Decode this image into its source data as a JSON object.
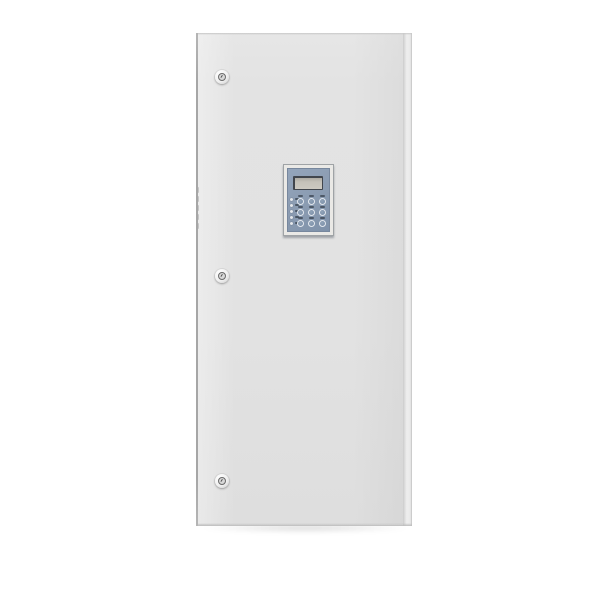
{
  "colors": {
    "background": "#ffffff",
    "cabinet_face": "#e2e2e2",
    "cabinet_side": "#eeeeee",
    "cabinet_edge_left": "#a6a6a6",
    "cabinet_edge_top": "#c9c9c9",
    "cabinet_edge_bottom": "#bdbdbd",
    "panel_bezel": "#eae9e6",
    "panel_face": "#8a9bb1",
    "panel_face_light": "#94a5bb",
    "panel_border": "#77879d",
    "lcd_frame": "#41464d",
    "lcd_screen": "#c4c1b9",
    "button_face": "#7e92aa",
    "button_ring": "#e3e8ee",
    "button_label": "#39434f",
    "led_dot": "#e4e8ec",
    "latch_face": "#f0f0f0",
    "latch_ring": "#6a6a6a",
    "latch_center": "#d8d8d8"
  },
  "cabinet": {
    "latch_count": 3,
    "hinge_mark_count": 5
  },
  "hmi_panel": {
    "led_count": 5,
    "keypad_rows": 3,
    "keypad_cols": 3,
    "lcd_text": ""
  }
}
